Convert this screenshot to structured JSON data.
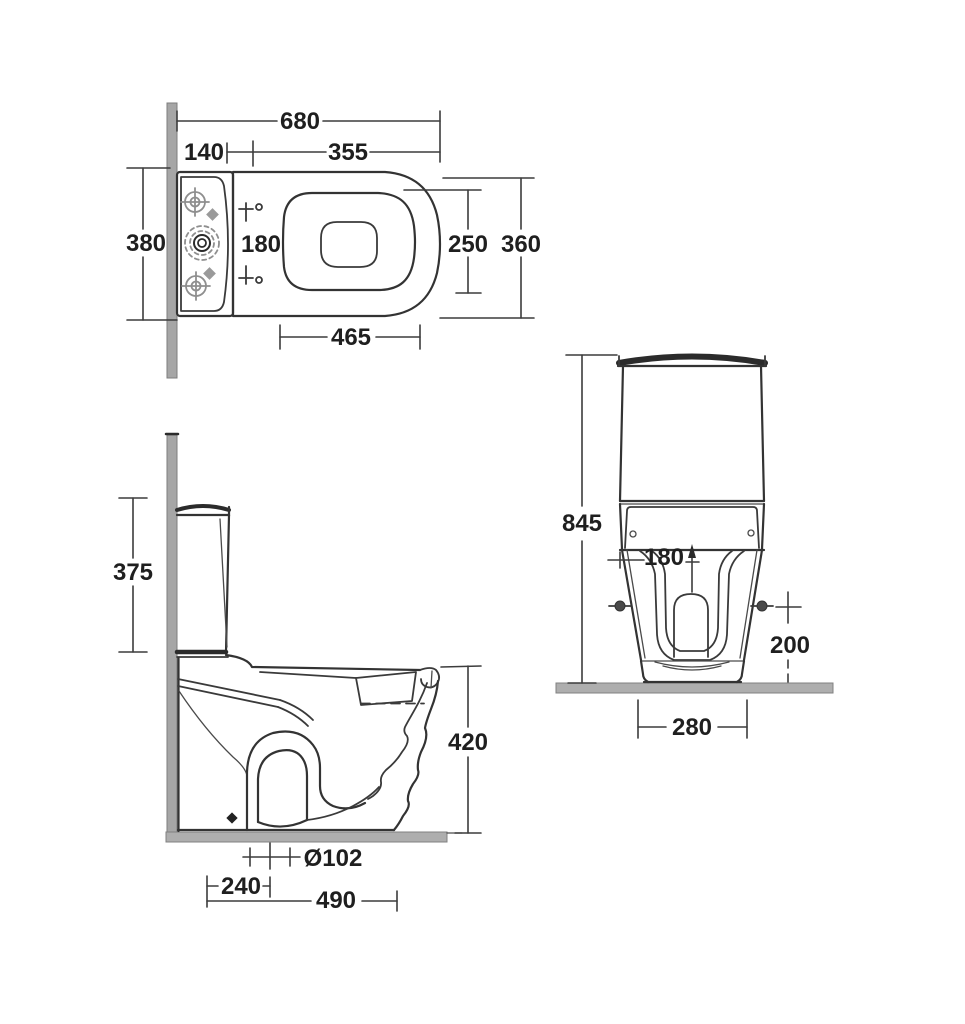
{
  "drawing_title": "close-coupled toilet dimensional drawing",
  "labels": {
    "top_view": {
      "overall_length": "680",
      "cistern_depth": "140",
      "hinge_to_front": "355",
      "width_at_wall": "380",
      "hinge_centres": "180",
      "seat_inner_width": "250",
      "overall_width": "360",
      "bowl_length": "465"
    },
    "side_view": {
      "cistern_height": "375",
      "rim_height": "420",
      "outlet_diameter": "Ø102",
      "outlet_setout": "240",
      "projection": "490"
    },
    "front_view": {
      "overall_height": "845",
      "flush_offset": "180",
      "fixing_height": "200",
      "base_width": "280"
    }
  },
  "colors": {
    "line": "#333333",
    "wall": "#a6a6a6",
    "floor": "#aeaeae",
    "light_detail": "#8f8f8f",
    "background": "#ffffff"
  }
}
